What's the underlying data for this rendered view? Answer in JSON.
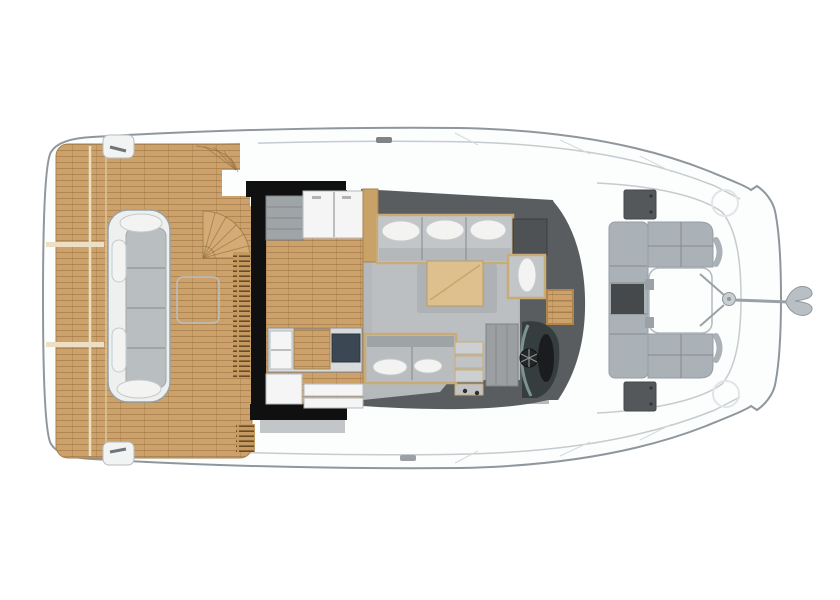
{
  "meta": {
    "type": "yacht-deck-floor-plan",
    "view": "top-down, bow pointing right",
    "visible_text": ""
  },
  "palette": {
    "bg": "#ffffff",
    "hull-fill": "#fcfdfd",
    "hull-line": "#8f979d",
    "deck-line": "#c6cbcf",
    "teak": "#cda26a",
    "teak-line": "#7a552a",
    "teak-light": "#d4ab74",
    "pad-white": "#f2f3f3",
    "bench-white": "#eef0ef",
    "bench-seat": "#b9bec0",
    "pillow": "#f3f4f2",
    "wall-black": "#101010",
    "wall-dark": "#595d5f",
    "salon-floor": "#b6b9bb",
    "wood-trim": "#c9ab77",
    "table-wood": "#ddc08d",
    "cabinet-gray": "#9fa4a7",
    "counter-white": "#f4f5f4",
    "island-dark": "#3c4754",
    "helm-dark": "#353d3f",
    "helm-glass": "#7d938d",
    "wheel-black": "#1a1c1d",
    "seat-gray": "#aab2b8",
    "seat-dark": "#46494c",
    "hatch-dark": "#54585b",
    "anchor-gray": "#b9c0c5",
    "shadow-gray": "#a9adaf"
  },
  "elements": {
    "hull": "white hull outline with inner deck seams",
    "swim-platform": "teak swim platform at stern (left)",
    "aft-deck": "teak cockpit deck",
    "cockpit-bench": "curved white/gray bench sofa with pillows",
    "cockpit-table-outline": "faint folded table outline on teak",
    "flybridge-stairs": "quarter-circle spiral staircase fan",
    "louvre-vents": "slatted vent strips beside salon aft wall",
    "salon-walls": "thick black aft walls of salon",
    "galley": "galley counters, drawers and island with fridge and cooktop",
    "salon-sofa": "L-shaped sofa with three white pillows",
    "coffee-table": "light wood coffee table on gray rug",
    "settee": "forward settee with two pillows",
    "companionway-steps": "steps down to cabins",
    "helm-console": "dark helm console",
    "steering-wheel": "black steering wheel",
    "windshield-step": "wood step panel at windshield",
    "foredeck-hatches": "two dark deck hatches",
    "foredeck-seating": "U-shaped gray bow seating with dark locker",
    "foredeck-table": "white drop-down table between bow seats",
    "anchor": "bow anchor with roller and shank"
  }
}
